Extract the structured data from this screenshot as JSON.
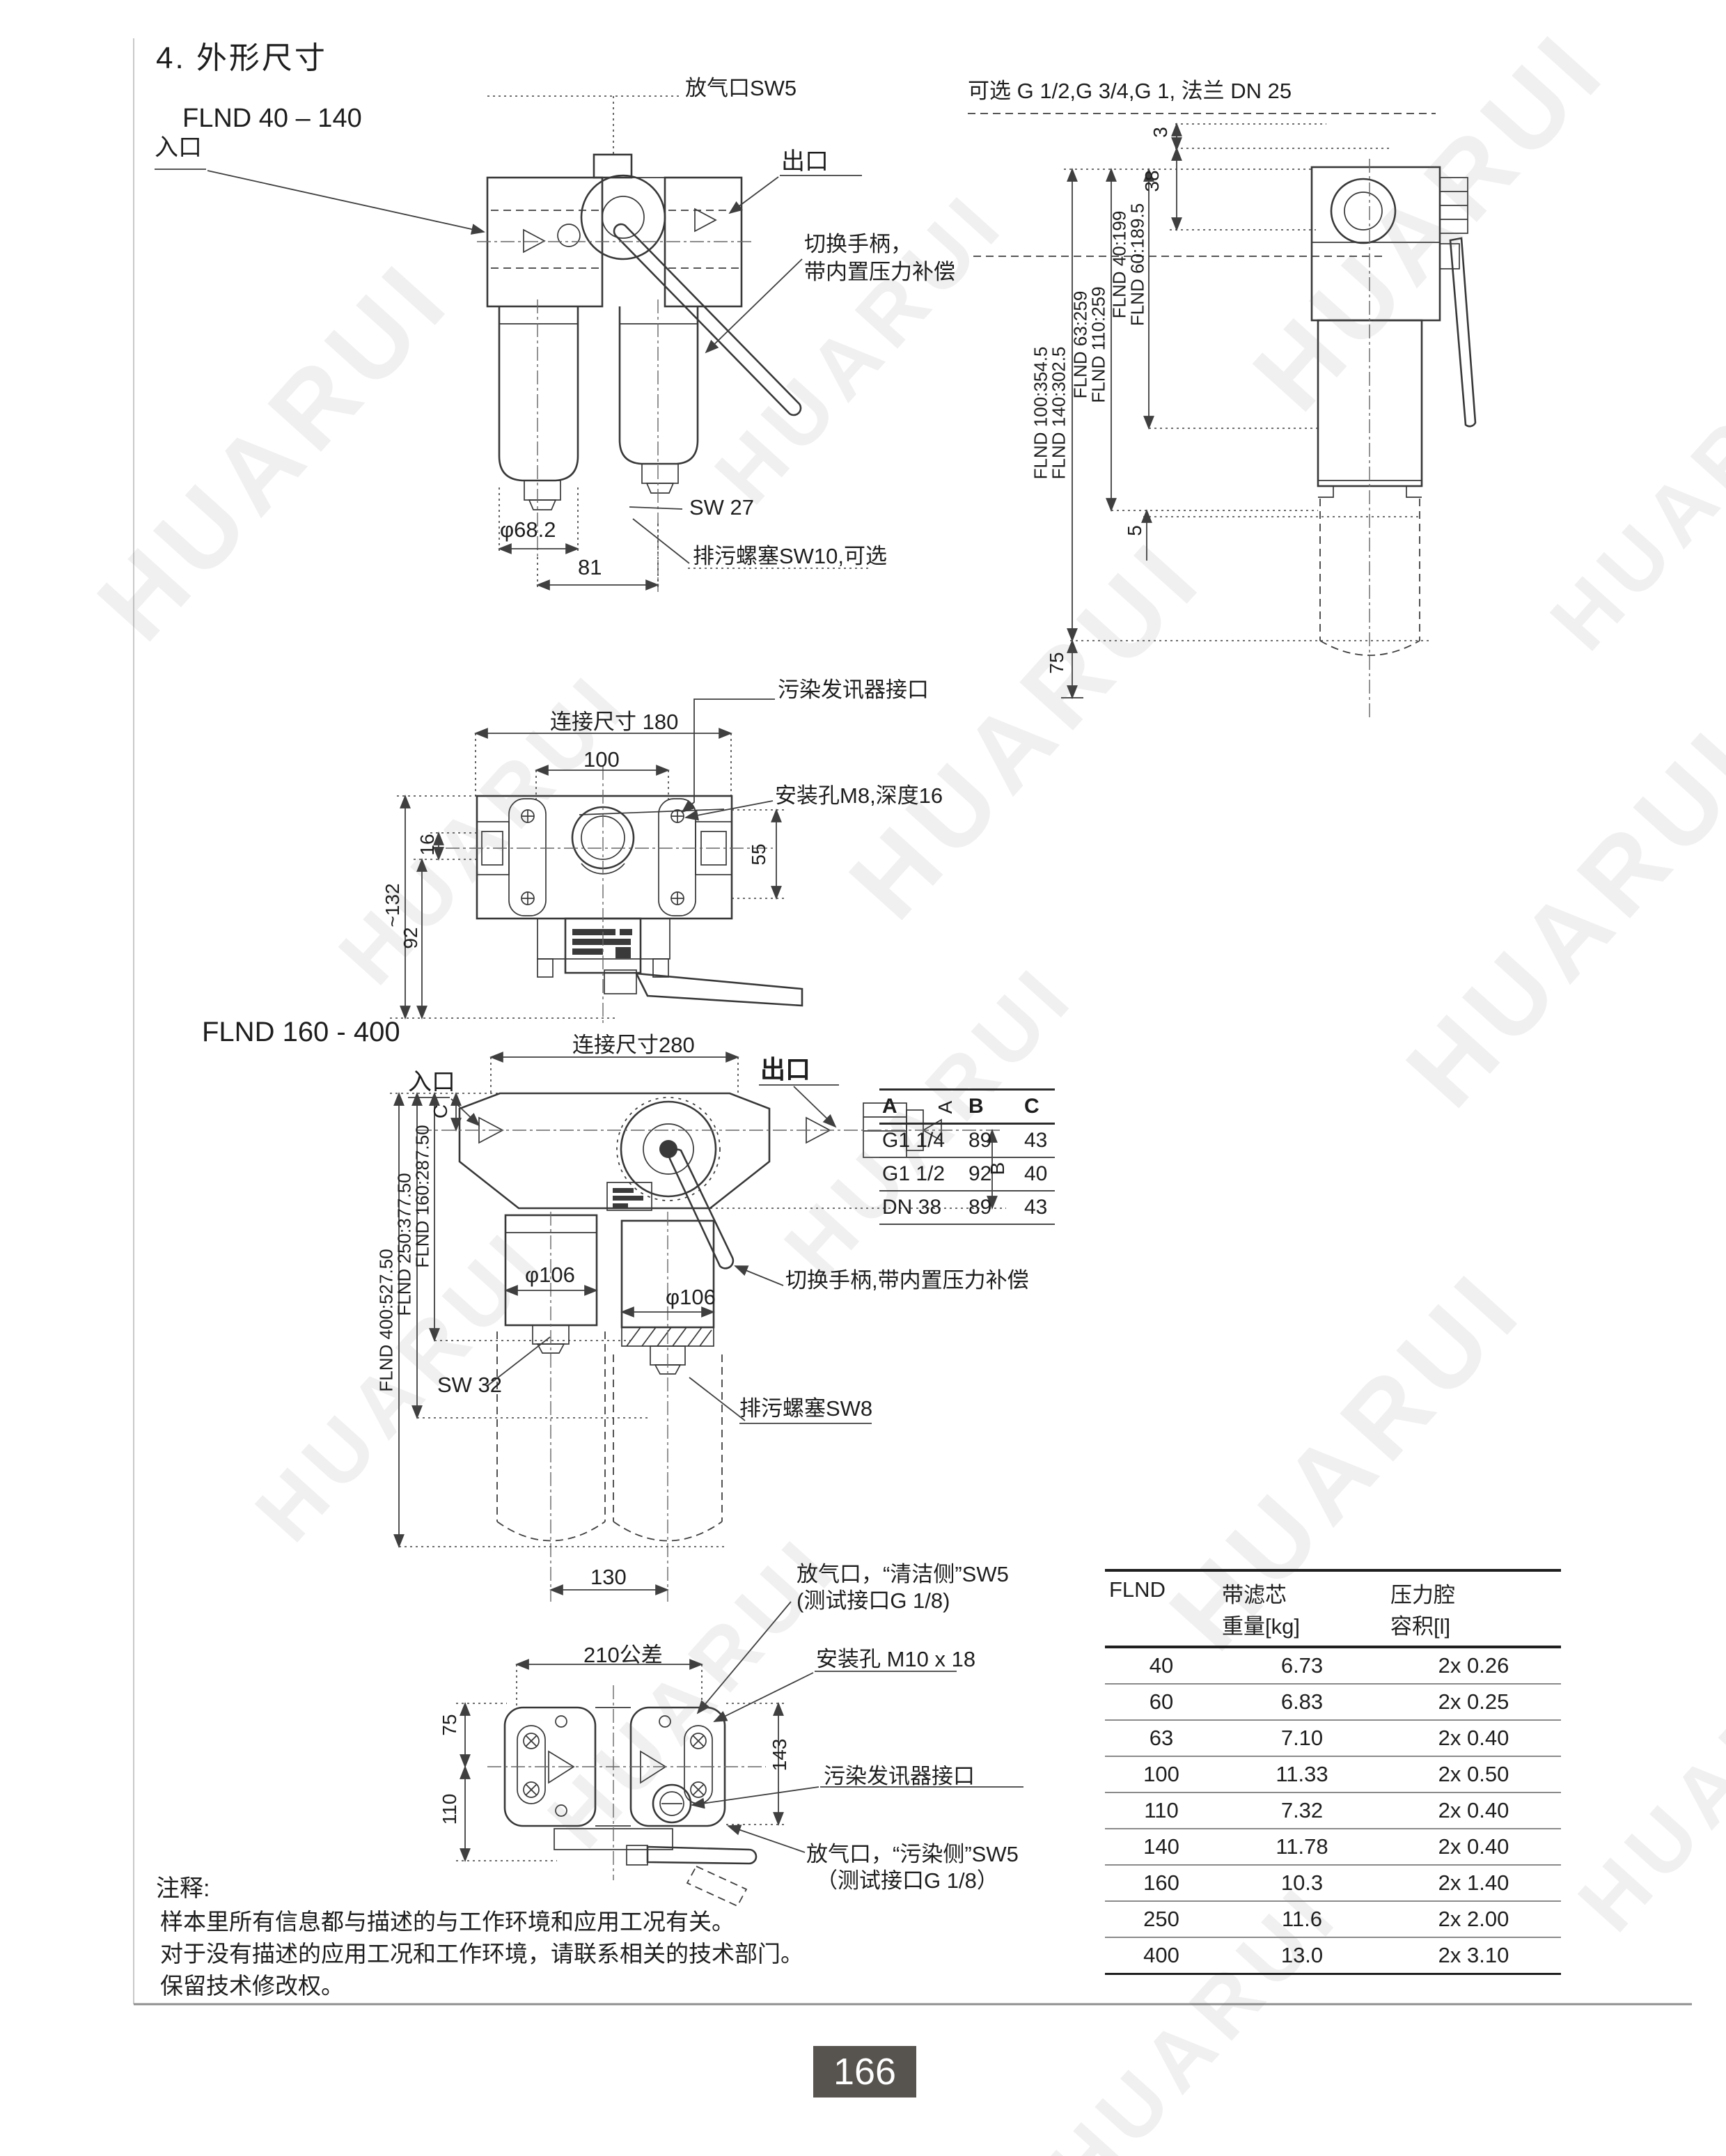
{
  "page": {
    "title": "4. 外形尺寸",
    "page_number": "166",
    "watermark": "HUARUI"
  },
  "flnd40": {
    "title": "FLND 40 – 140",
    "front": {
      "vent": "放气口SW5",
      "inlet": "入口",
      "outlet": "出口",
      "handle_line1": "切换手柄，",
      "handle_line2": "带内置压力补偿",
      "sw": "SW 27",
      "drain": "排污螺塞SW10,可选",
      "diameter": "φ68.2",
      "spacing": "81"
    },
    "side": {
      "ports": "可选 G 1/2,G 3/4,G 1, 法兰 DN 25",
      "dim3": "3",
      "dim38": "38",
      "dim5": "5",
      "dim75": "75",
      "heights": [
        "FLND 100:354.5",
        "FLND 140:302.5",
        "FLND 63:259",
        "FLND 110:259",
        "FLND 40:199",
        "FLND 60:189.5"
      ]
    },
    "top": {
      "signal": "污染发讯器接口",
      "conn": "连接尺寸 180",
      "dim100": "100",
      "mount": "安装孔M8,深度16",
      "dim16": "16",
      "dim55": "55",
      "dim132": "~132",
      "dim92": "92"
    }
  },
  "flnd160": {
    "title": "FLND 160 - 400",
    "front": {
      "inlet": "入口",
      "conn": "连接尺寸280",
      "outlet": "出口",
      "dimA": "A",
      "dimB": "B",
      "dimC": "C",
      "handle": "切换手柄,带内置压力补偿",
      "dia_left": "φ106",
      "dia_right": "φ106",
      "drain": "排污螺塞SW8",
      "sw": "SW 32",
      "dim130": "130",
      "heights": [
        "FLND 400:527.50",
        "FLND 250:377.50",
        "FLND 160:287.50"
      ],
      "port_table": {
        "headers": [
          "A",
          "B",
          "C"
        ],
        "rows": [
          [
            "G1 1/4",
            "89",
            "43"
          ],
          [
            "G1 1/2",
            "92",
            "40"
          ],
          [
            "DN 38",
            "89",
            "43"
          ]
        ]
      }
    },
    "bottom": {
      "vent_clean_1": "放气口，“清洁侧”SW5",
      "vent_clean_2": "(测试接口G 1/8)",
      "mount": "安装孔 M10 x 18",
      "tolerance": "210公差",
      "dim75": "75",
      "dim110": "110",
      "dim143": "143",
      "signal": "污染发讯器接口",
      "vent_dirty_1": "放气口，“污染侧”SW5",
      "vent_dirty_2": "（测试接口G 1/8）"
    }
  },
  "weight_table": {
    "col_model": "FLND",
    "col_weight_1": "带滤芯",
    "col_weight_2": "重量[kg]",
    "col_volume_1": "压力腔",
    "col_volume_2": "容积[l]",
    "rows": [
      [
        "40",
        "6.73",
        "2x 0.26"
      ],
      [
        "60",
        "6.83",
        "2x 0.25"
      ],
      [
        "63",
        "7.10",
        "2x 0.40"
      ],
      [
        "100",
        "11.33",
        "2x 0.50"
      ],
      [
        "110",
        "7.32",
        "2x 0.40"
      ],
      [
        "140",
        "11.78",
        "2x 0.40"
      ],
      [
        "160",
        "10.3",
        "2x 1.40"
      ],
      [
        "250",
        "11.6",
        "2x 2.00"
      ],
      [
        "400",
        "13.0",
        "2x 3.10"
      ]
    ]
  },
  "notes": {
    "heading": "注释:",
    "lines": [
      "样本里所有信息都与描述的与工作环境和应用工况有关。",
      "对于没有描述的应用工况和工作环境，请联系相关的技术部门。",
      "保留技术修改权。"
    ]
  }
}
